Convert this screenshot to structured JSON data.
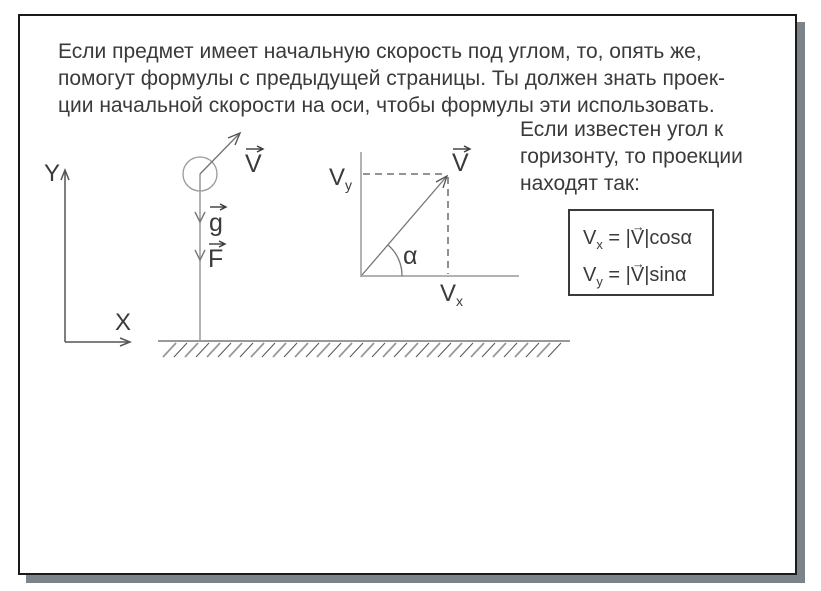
{
  "page": {
    "intro_lines": [
      "Если предмет имеет начальную скорость под углом, то, опять же,",
      "помогут формулы с предыдущей страницы. Ты должен знать проек-",
      "ции начальной скорости на оси, чтобы формулы эти использовать."
    ],
    "side_lines": [
      "Если известен угол к",
      "горизонту, то проекции",
      "находят так:"
    ]
  },
  "diagram": {
    "axes": {
      "y_label": "Y",
      "x_label": "X"
    },
    "ball": {
      "velocity_label": "V",
      "gravity_label": "g",
      "force_label": "F"
    },
    "vector_plot": {
      "v_label": "V",
      "vy_base": "V",
      "vy_sub": "y",
      "vx_base": "V",
      "vx_sub": "x",
      "angle_label": "α"
    }
  },
  "formula_box": {
    "lines": [
      {
        "base": "V",
        "sub": "x",
        "mid": " = |",
        "vec": "V",
        "end": "|cosα"
      },
      {
        "base": "V",
        "sub": "y",
        "mid": " = |",
        "vec": "V",
        "end": "|sinα"
      }
    ]
  },
  "icons": {
    "vector_arrow": "→"
  },
  "colors": {
    "page_border": "#1a1a1a",
    "page_shadow": "#7c848a",
    "text": "#3a3a3a",
    "line_gray": "#999999",
    "line_mid": "#777777",
    "line_dark": "#555555"
  }
}
